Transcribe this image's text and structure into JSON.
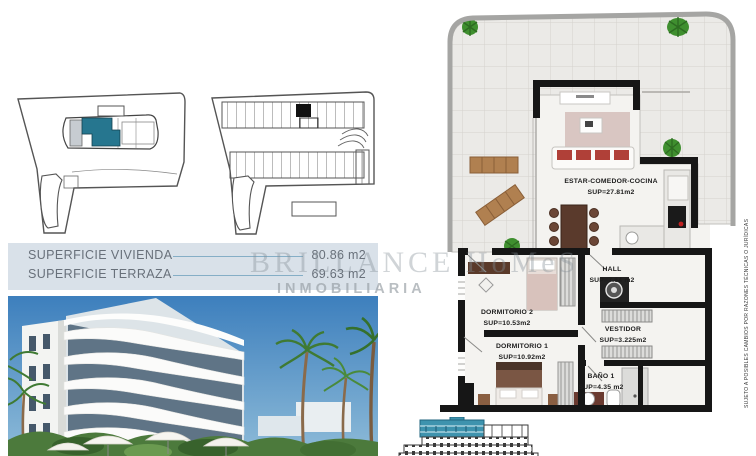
{
  "sheet": {
    "area_table": {
      "rows": [
        {
          "label": "SUPERFICIE VIVIENDA",
          "value": "80.86 m2"
        },
        {
          "label": "SUPERFICIE TERRAZA",
          "value": "69.63 m2"
        }
      ]
    },
    "watermark": {
      "brand": "BRILLANCE HoMeS",
      "subtitle": "INMOBILIARIA"
    },
    "floor_plan": {
      "rooms": [
        {
          "name": "ESTAR-COMEDOR-COCINA",
          "area": "SUP=27.81m2"
        },
        {
          "name": "HALL",
          "area": "SUP=7.64  m2"
        },
        {
          "name": "DORMITORIO 2",
          "area": "SUP=10.53m2"
        },
        {
          "name": "VESTIDOR",
          "area": "SUP=3.225m2"
        },
        {
          "name": "DORMITORIO 1",
          "area": "SUP=10.92m2"
        },
        {
          "name": "BAÑO 1",
          "area": "SUP=4.35 m2"
        }
      ]
    },
    "disclaimer": "SUJETO A POSIBLES CAMBIOS POR RAZONES TÉCNICAS O JURÍDICAS",
    "colors": {
      "unit_highlight": "#26768f",
      "elevation_highlight": "#3e93ae",
      "table_background": "#d9e1e9",
      "leader_line": "#85aec6"
    }
  }
}
